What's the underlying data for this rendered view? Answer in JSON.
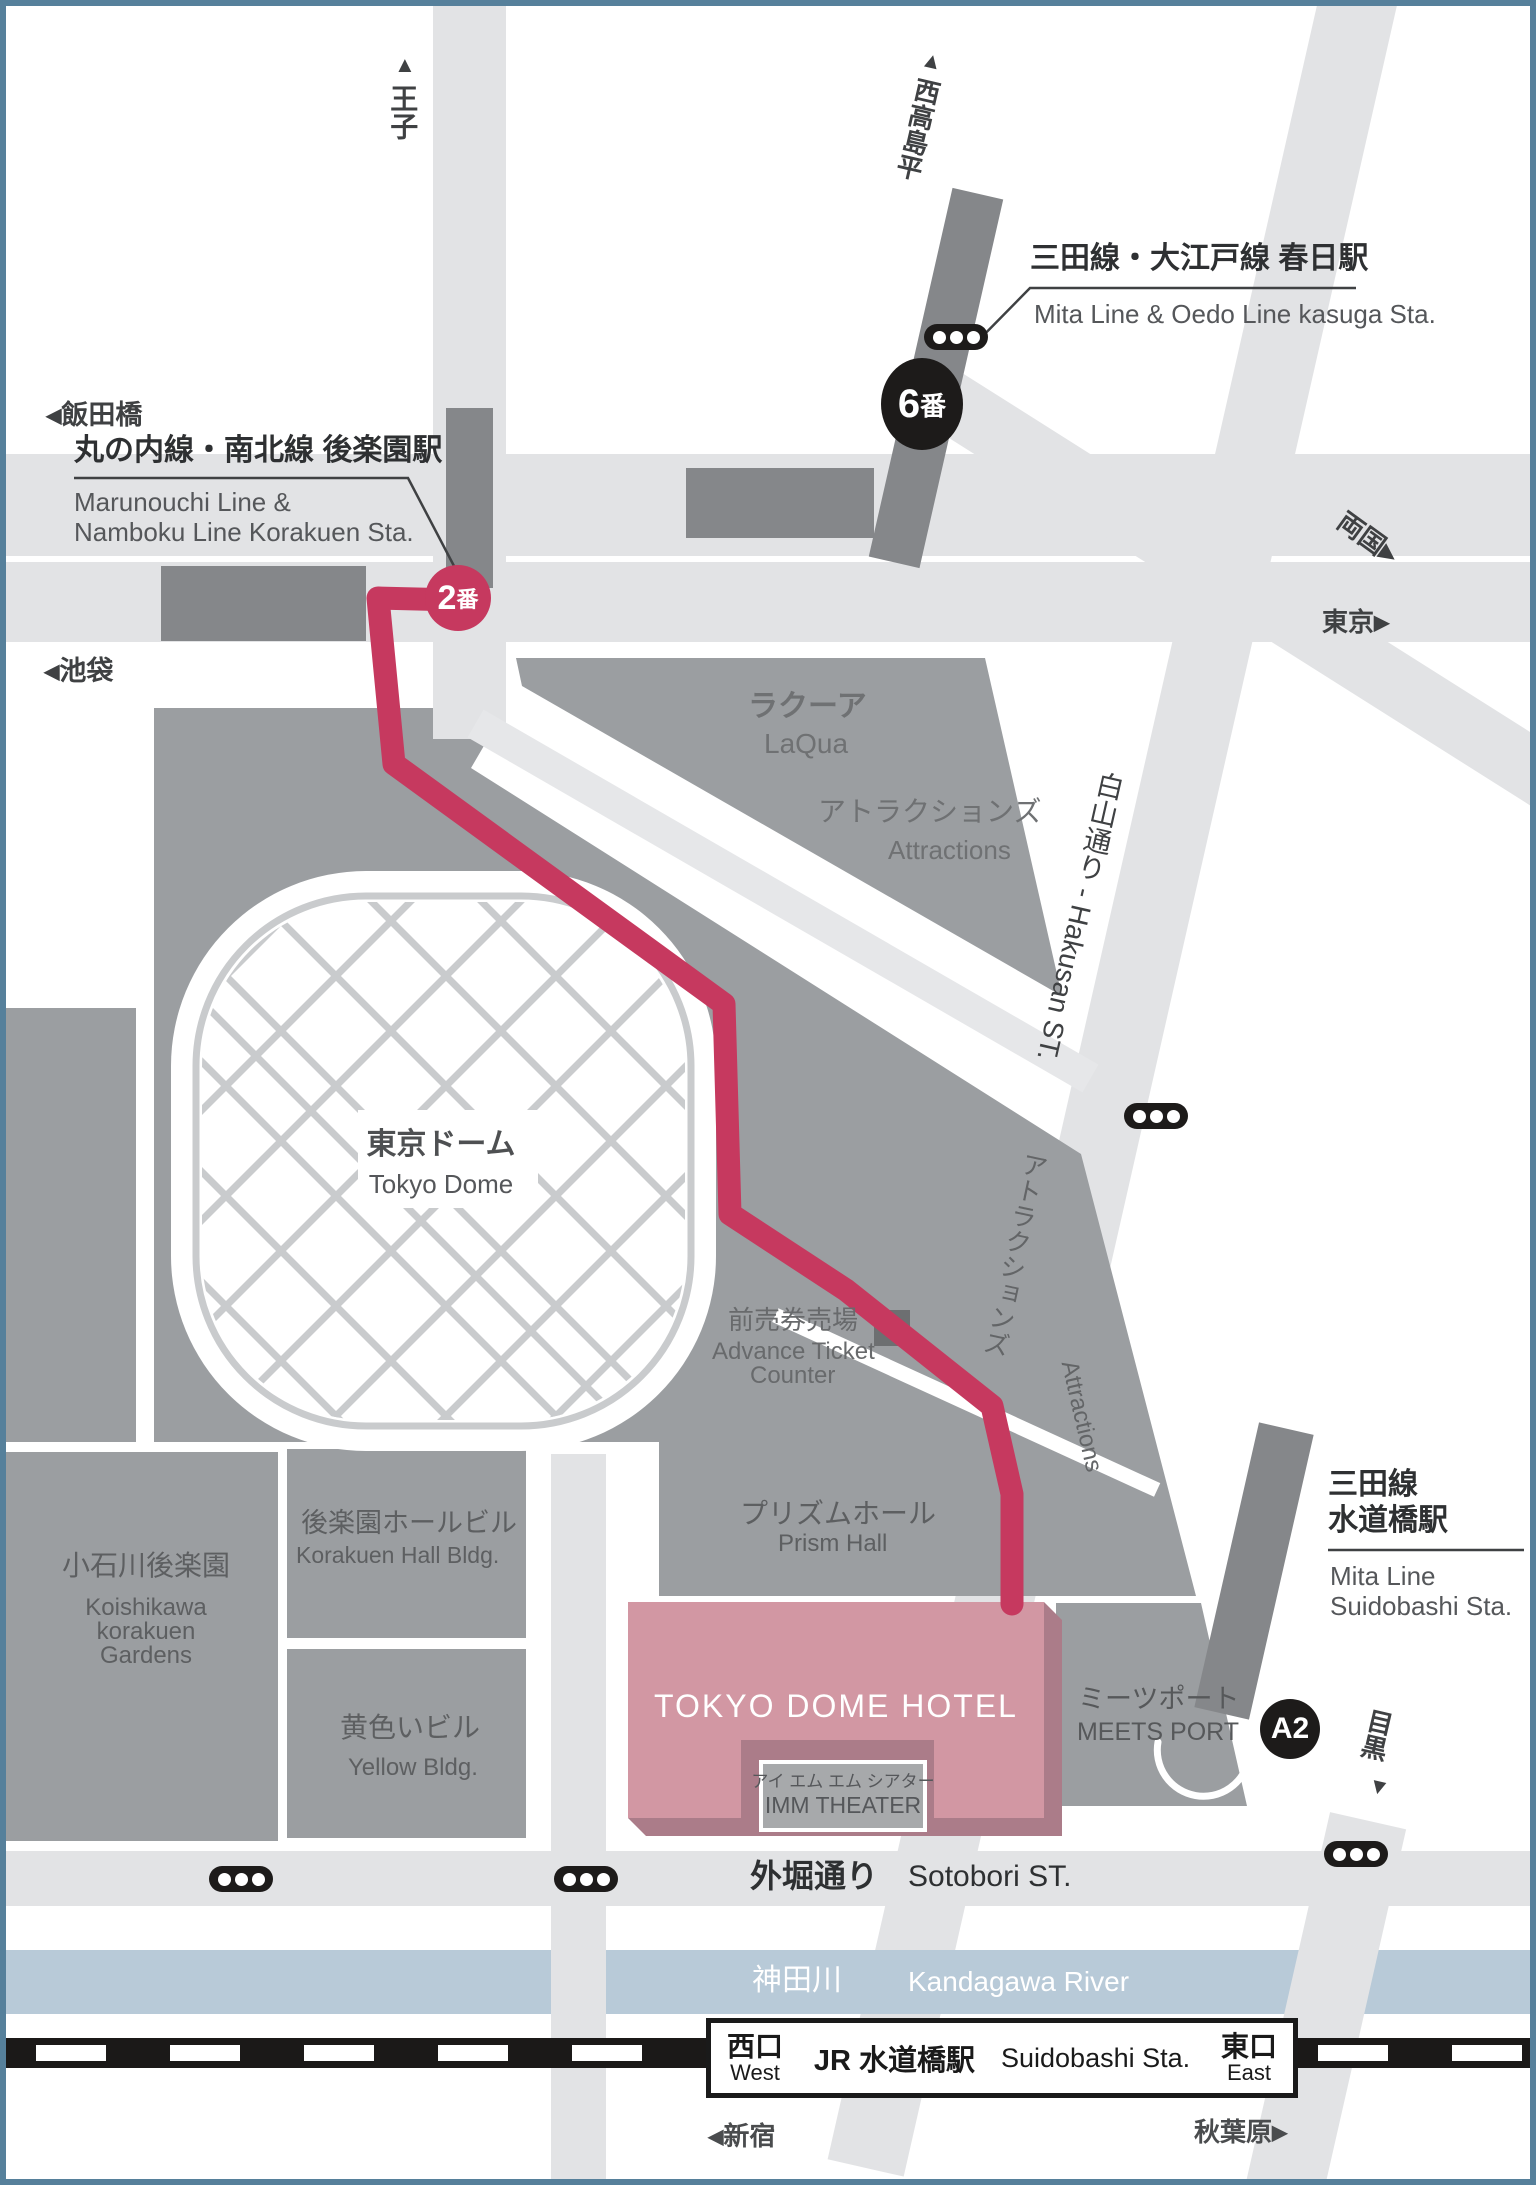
{
  "colors": {
    "frame": "#56809b",
    "road": "#e2e3e5",
    "building": "#9b9ea1",
    "station": "#85878a",
    "route": "#c6395f",
    "hotel": "#d297a3",
    "hotel_shadow": "#ab7c89",
    "river": "#b8cad8",
    "rail": "#1b1918",
    "dome_hatch": "#c9cbcd"
  },
  "icons": {
    "left": "◀",
    "right": "▶",
    "up": "▲",
    "down": "▼"
  },
  "directions": {
    "oji": "王子",
    "nishi_takashimadaira": "西高島平",
    "iidabashi": "飯田橋",
    "ikebukuro": "池袋",
    "ryogoku": "両国",
    "tokyo": "東京",
    "meguro": "目黒",
    "shinjuku": "新宿",
    "akihabara": "秋葉原"
  },
  "stations": {
    "korakuen": {
      "jp": "丸の内線・南北線  後楽園駅",
      "en_line1": "Marunouchi Line &",
      "en_line2": "Namboku Line Korakuen Sta.",
      "exit_num": "2",
      "exit_suffix": "番"
    },
    "kasuga": {
      "jp": "三田線・大江戸線 春日駅",
      "en": "Mita Line & Oedo Line kasuga Sta.",
      "exit_num": "6",
      "exit_suffix": "番"
    },
    "suidobashi_mita": {
      "jp_line1": "三田線",
      "jp_line2": "水道橋駅",
      "en_line1": "Mita Line",
      "en_line2": "Suidobashi Sta.",
      "exit_label": "A2"
    },
    "suidobashi_jr": {
      "name_jp": "JR 水道橋駅",
      "name_en": "Suidobashi Sta.",
      "west_jp": "西口",
      "west_en": "West",
      "east_jp": "東口",
      "east_en": "East"
    }
  },
  "roads": {
    "hakusan": "白山通り - Hakusan ST.",
    "sot obori_jp": "",
    "sotobori_jp": "外堀通り",
    "sotobori_en": "Sotobori ST."
  },
  "river": {
    "jp": "神田川",
    "en": "Kandagawa River"
  },
  "places": {
    "laqua": {
      "jp": "ラクーア",
      "en": "LaQua"
    },
    "attractions_upper": {
      "jp": "アトラクションズ",
      "en": "Attractions"
    },
    "attractions_lower": {
      "jp": "アトラクションズ",
      "en": "Attractions"
    },
    "tokyo_dome": {
      "jp": "東京ドーム",
      "en": "Tokyo Dome"
    },
    "ticket": {
      "jp": "前売券売場",
      "en_line1": "Advance Ticket",
      "en_line2": "Counter"
    },
    "prism": {
      "jp": "プリズムホール",
      "en": "Prism Hall"
    },
    "koishikawa": {
      "jp": "小石川後楽園",
      "en_line1": "Koishikawa",
      "en_line2": "korakuen",
      "en_line3": "Gardens"
    },
    "korakuen_hall": {
      "jp": "後楽園ホールビル",
      "en": "Korakuen Hall Bldg."
    },
    "yellow": {
      "jp": "黄色いビル",
      "en": "Yellow Bldg."
    },
    "hotel": {
      "name": "TOKYO DOME HOTEL"
    },
    "imm": {
      "jp": "アイ エム エム シアター",
      "en": "IMM THEATER"
    },
    "meets_port": {
      "jp": "ミーツポート",
      "en": "MEETS PORT"
    }
  }
}
